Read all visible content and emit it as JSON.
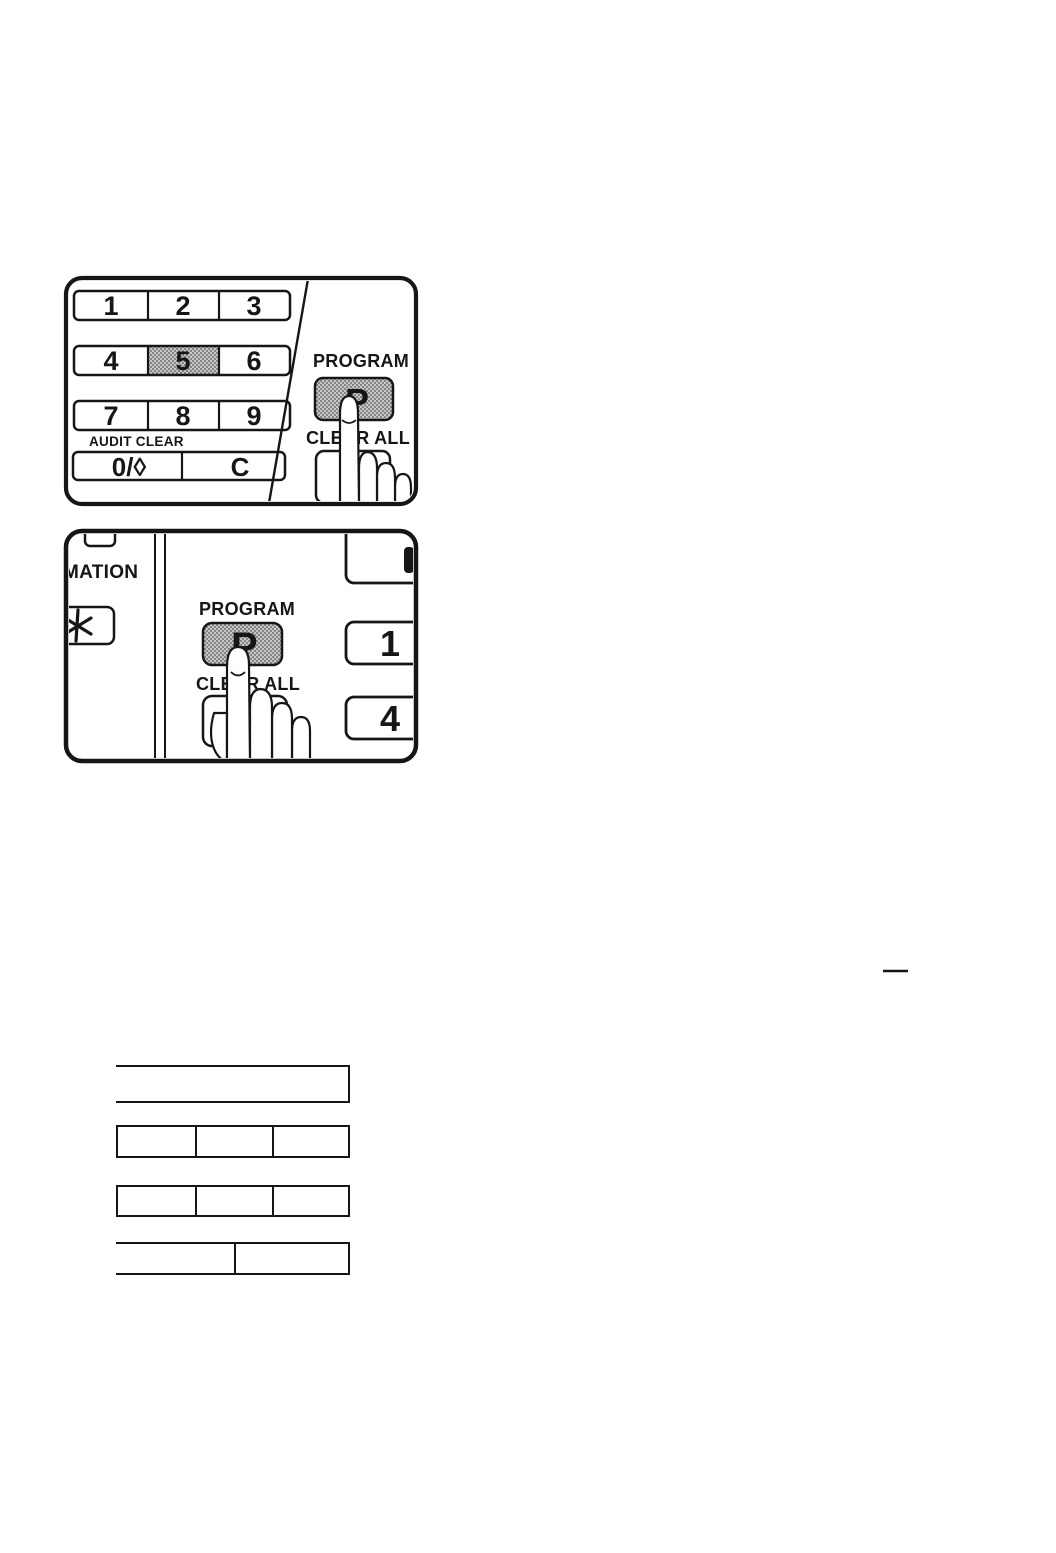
{
  "page": {
    "kind": "scanned manual page",
    "ink_color": "#161616",
    "shaded_key_bg": "#c6c6c6",
    "shaded_key_dot": "#6b6b6b"
  },
  "panel_top": {
    "keypad": {
      "rows": [
        [
          "1",
          "2",
          "3"
        ],
        [
          "4",
          "5",
          "6"
        ],
        [
          "7",
          "8",
          "9"
        ]
      ],
      "audit_clear_label": "AUDIT CLEAR",
      "zero_key": "0/◊",
      "clear_key": "C",
      "highlighted_key": "5"
    },
    "program_label": "PROGRAM",
    "program_key": "P",
    "clear_all_label": "CLEAR ALL"
  },
  "panel_bottom": {
    "information_label_partial": "MATION",
    "asterisk_key_label": "*",
    "program_label": "PROGRAM",
    "program_key": "P",
    "clear_all_label": "CLEAR ALL",
    "side_key_1": "1",
    "side_key_4": "4"
  },
  "blank_form": {
    "rows": [
      {
        "cells": 1,
        "open_left": true
      },
      {
        "cells": 3,
        "open_left": false
      },
      {
        "cells": 3,
        "open_left": false
      },
      {
        "cells": 2,
        "open_left": true
      }
    ]
  }
}
